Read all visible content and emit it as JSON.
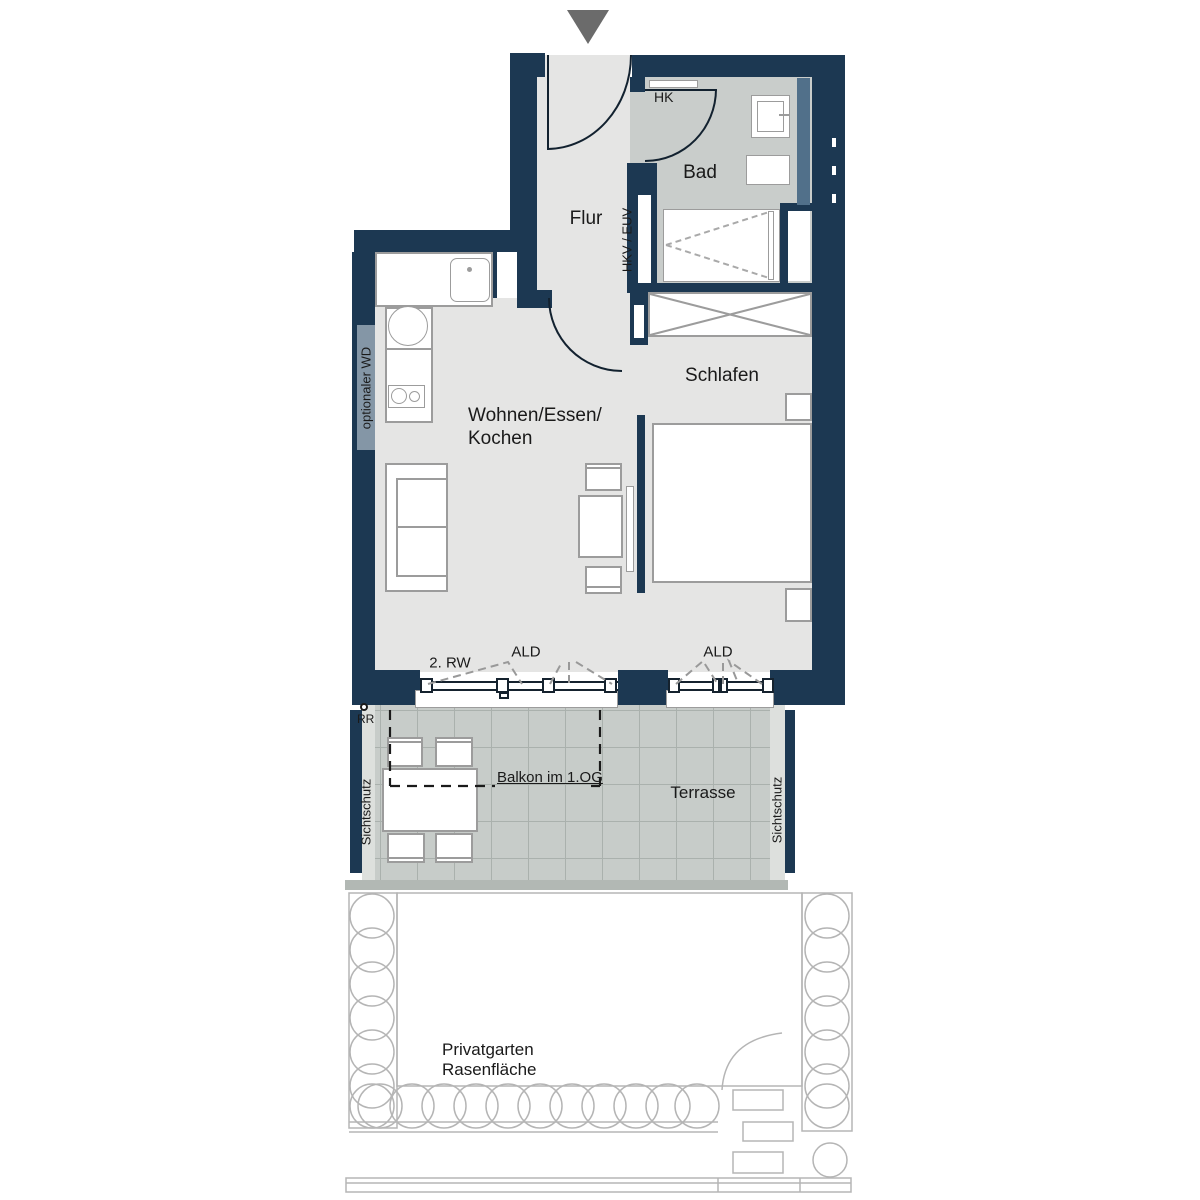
{
  "floorplan": {
    "rooms": {
      "flur": "Flur",
      "bad": "Bad",
      "schlafen": "Schlafen",
      "wohnen_line1": "Wohnen/Essen/",
      "wohnen_line2": "Kochen",
      "terrasse": "Terrasse",
      "garten_line1": "Privatgarten",
      "garten_line2": "Rasenfläche"
    },
    "annotations": {
      "hk": "HK",
      "hkv_euv": "HKV / EUV",
      "optionaler_wd": "optionaler WD",
      "rw": "2. RW",
      "ald_left": "ALD",
      "ald_right": "ALD",
      "rr": "RR",
      "sichtschutz_left": "Sichtschutz",
      "sichtschutz_right": "Sichtschutz",
      "balkon": "Balkon im 1.OG"
    },
    "colors": {
      "wall": "#1c3852",
      "floor": "#e5e5e4",
      "bad_floor": "#c9cdcb",
      "terrace": "#c7ccc9",
      "terrace_line": "#aab1ad",
      "slate_wd": "#8496a6",
      "slate_duct": "#51708a",
      "garden_line": "#b5b5b5",
      "furniture_line": "#9c9c9c",
      "ink": "#1a1a1a",
      "arrow": "#6b6b6b"
    }
  }
}
